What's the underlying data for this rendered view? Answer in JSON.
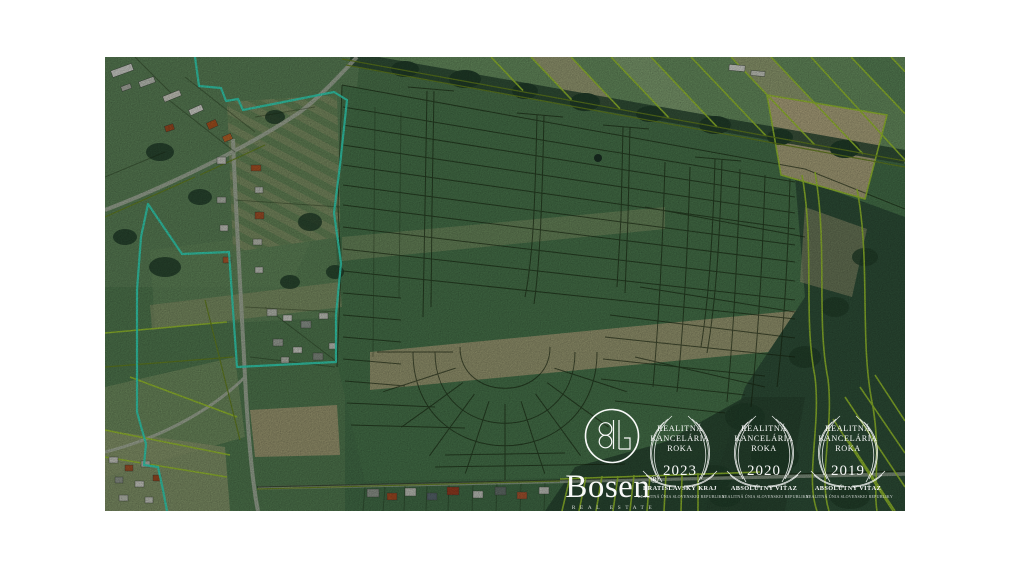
{
  "map": {
    "overlay_colors": {
      "ownership_boundary": "#38e6c4",
      "parcel_lines_lime": "#a6d32e",
      "parcel_lines_dark": "#17260f",
      "watermark": "#ffffff"
    }
  },
  "watermark": {
    "brand": {
      "name": "Bosen",
      "registered": "®",
      "tagline": "REAL ESTATE"
    },
    "badges": [
      {
        "title_line1": "REALITNÁ",
        "title_line2": "KANCELÁRIA",
        "title_line3": "ROKA",
        "year": "2023",
        "subtitle": "BRATISLAVSKÝ KRAJ",
        "fine_print": "REALITNÁ ÚNIA SLOVENSKEJ REPUBLIKY"
      },
      {
        "title_line1": "REALITNÁ",
        "title_line2": "KANCELÁRIA",
        "title_line3": "ROKA",
        "year": "2020",
        "subtitle": "ABSOLÚTNY VÍŤAZ",
        "fine_print": "REALITNÁ ÚNIA SLOVENSKEJ REPUBLIKY"
      },
      {
        "title_line1": "REALITNÁ",
        "title_line2": "KANCELÁRIA",
        "title_line3": "ROKA",
        "year": "2019",
        "subtitle": "ABSOLÚTNY VÍŤAZ",
        "fine_print": "REALITNÁ ÚNIA SLOVENSKEJ REPUBLIKY"
      }
    ]
  }
}
